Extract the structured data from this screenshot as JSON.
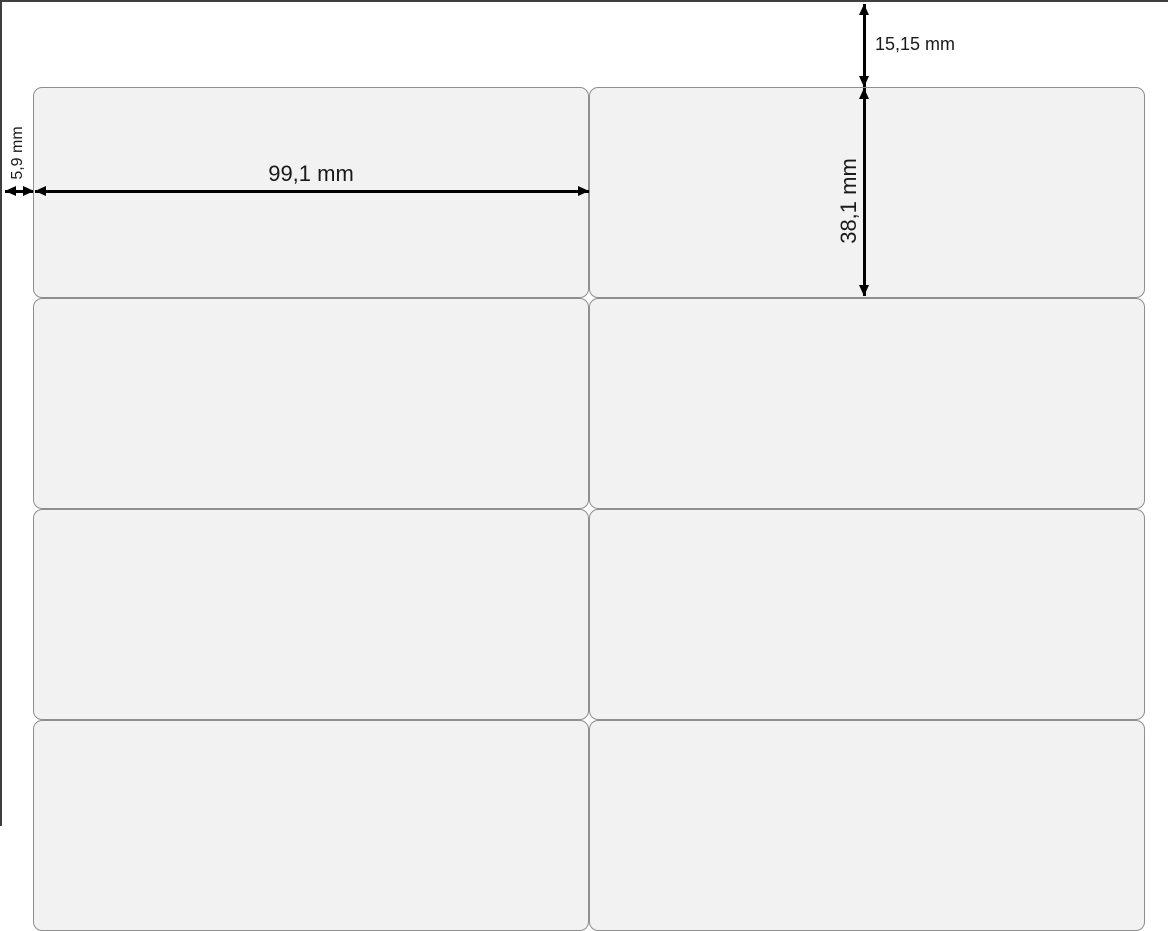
{
  "sheet": {
    "type": "label-sheet-template-diagram",
    "grid": {
      "columns": 2,
      "rows": 4
    },
    "dimensions": {
      "top_margin": "15,15 mm",
      "left_margin": "5,9 mm",
      "label_width": "99,1 mm",
      "label_height": "38,1 mm"
    },
    "colors": {
      "label_fill": "#f2f2f2",
      "label_border": "#8f8f8f",
      "sheet_border": "#3f3f3f",
      "arrow": "#000000",
      "background": "#ffffff"
    }
  }
}
